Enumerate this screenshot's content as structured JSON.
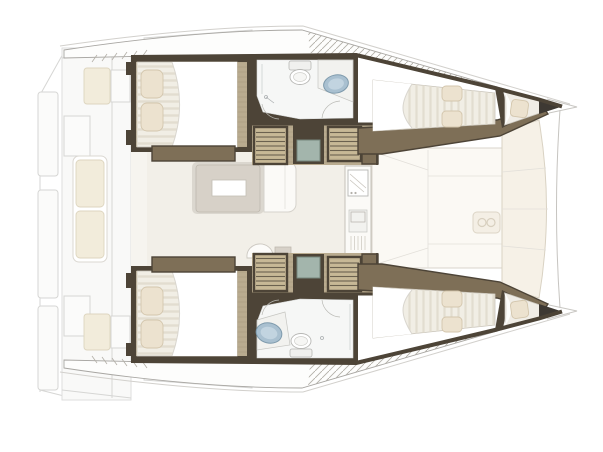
{
  "scene": {
    "kind": "catamaran-interior-floor-plan",
    "view": "top-down",
    "bow_direction": "right",
    "rooms": [
      "aft-cockpit",
      "saloon",
      "galley",
      "port-aft-cabin",
      "starboard-aft-cabin",
      "port-bathroom",
      "starboard-bathroom",
      "port-forward-cabin",
      "starboard-forward-cabin",
      "port-bow-berth",
      "starboard-bow-berth",
      "foredeck"
    ],
    "fixtures": [
      "double-bed",
      "pillow",
      "toilet",
      "sink-basin",
      "shower",
      "companionway-stairs",
      "dining-table",
      "sofa",
      "stool",
      "stove",
      "galley-sink",
      "bench-seat",
      "swim-steps",
      "bow-point"
    ]
  },
  "colors": {
    "wall": "#4d4437",
    "wood": "#b9ab8f",
    "woodDk": "#7e6f57",
    "tread": "#c7b896",
    "mattress": "#f1eee5",
    "pillow": "#ece2cf",
    "pillowLine": "#d3c6ad",
    "floorSaloon": "#f2efe8",
    "headFloor": "#f6f7f6",
    "basin": "#a9c0d0",
    "basinLine": "#7e9aac",
    "teal": "#a3b5ac",
    "tableGrey": "#d7d1c8",
    "panel": "#fbf9f4",
    "panelCream": "#f6f1e7",
    "cushion": "#f2ecdb",
    "cushionLine": "#ddd5bf"
  }
}
